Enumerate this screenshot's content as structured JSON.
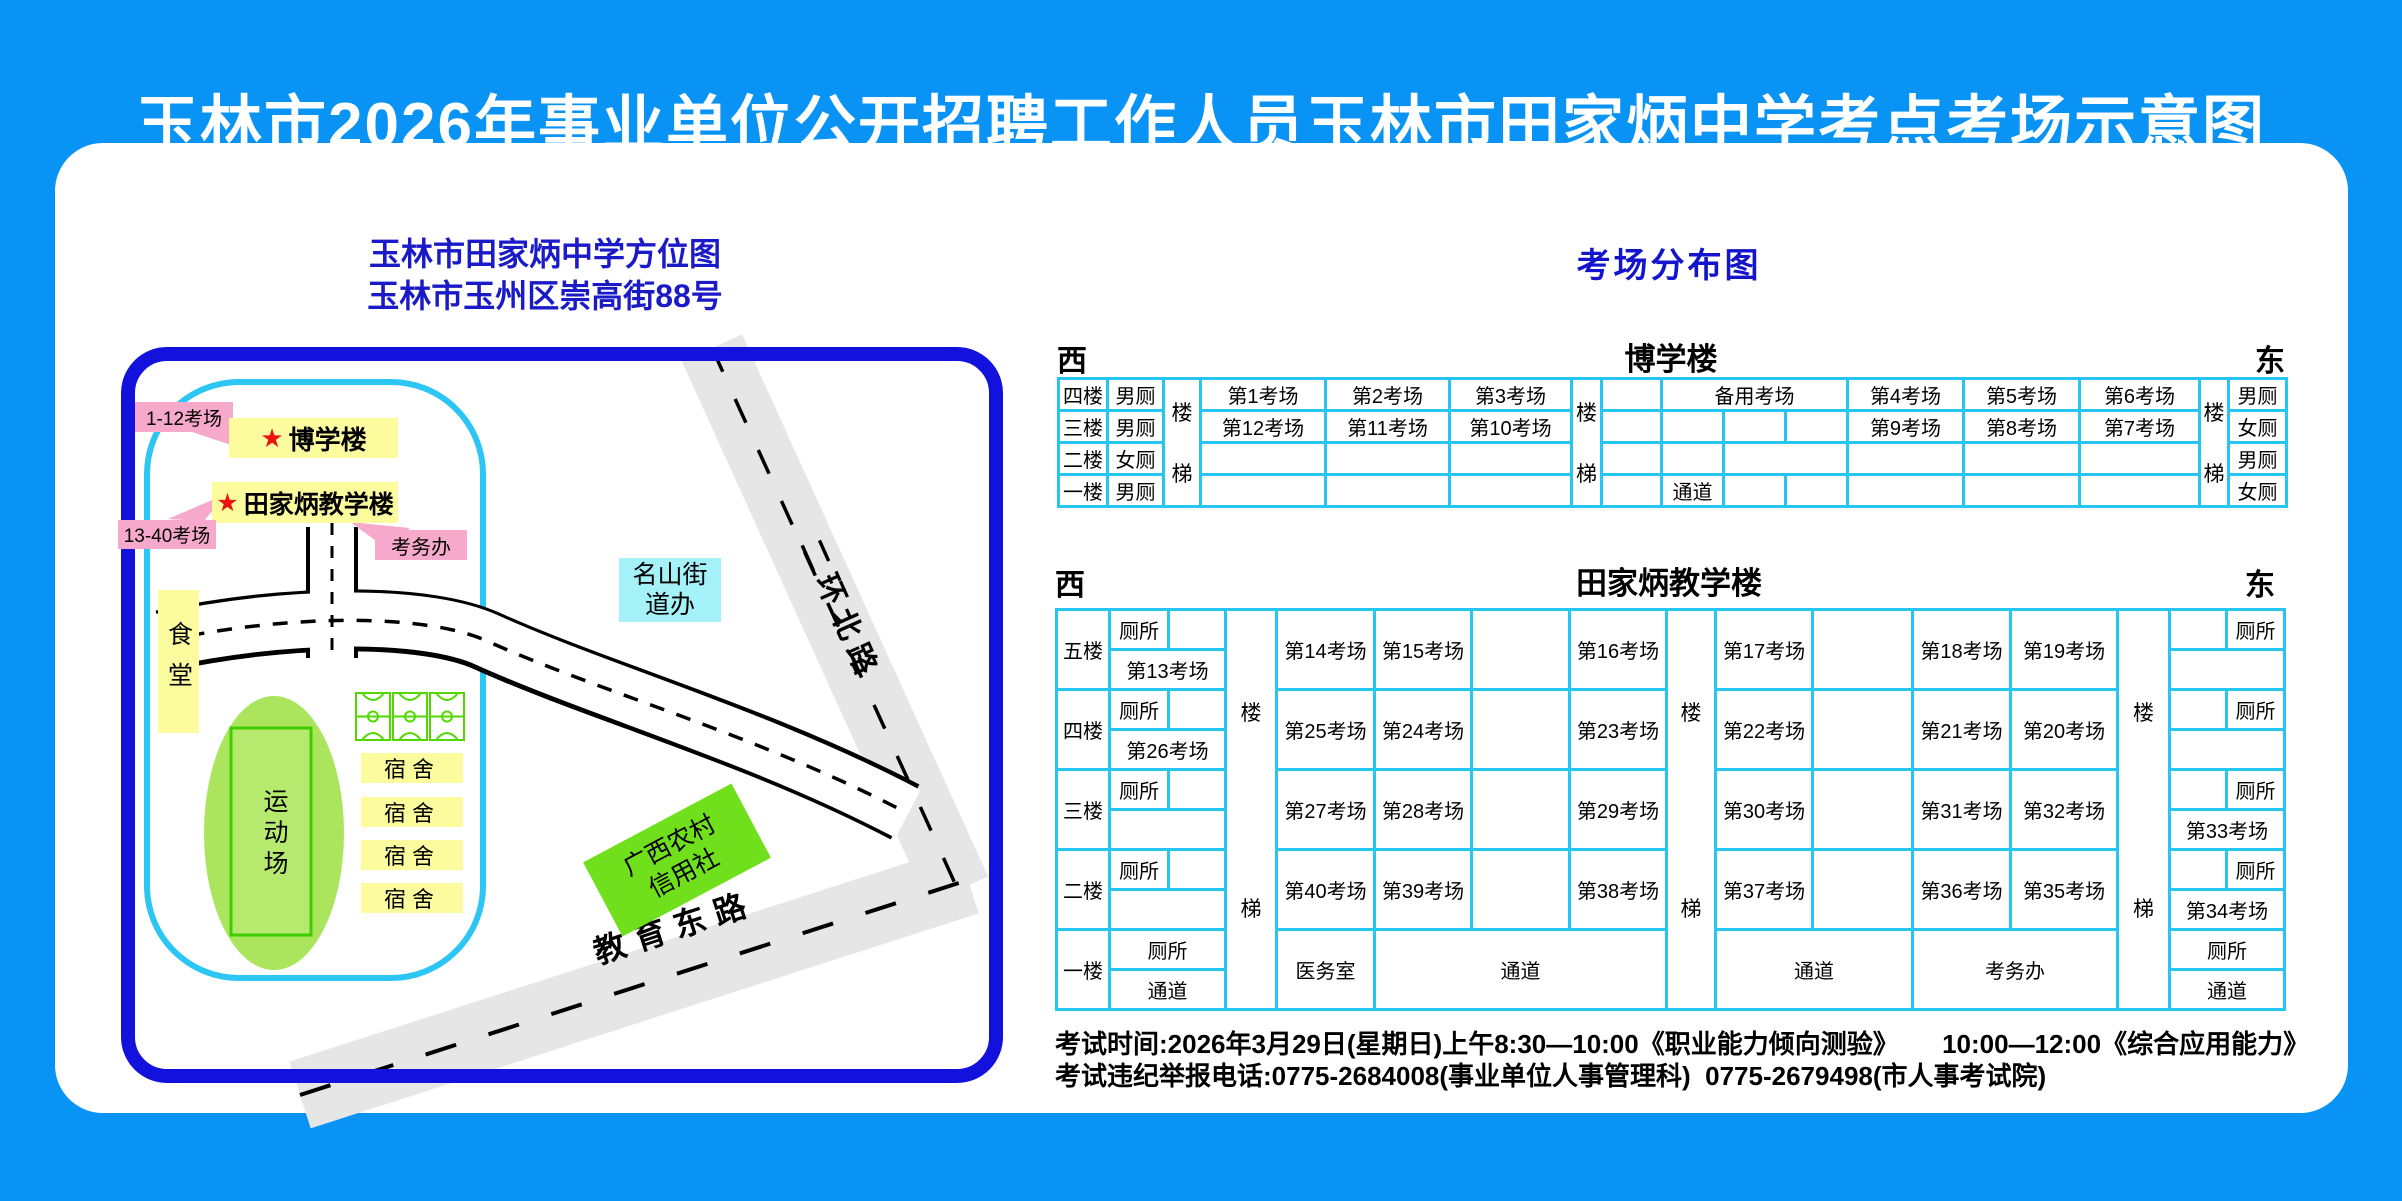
{
  "title": "玉林市2026年事业单位公开招聘工作人员玉林市田家炳中学考点考场示意图",
  "map": {
    "header_line1": "玉林市田家炳中学方位图",
    "header_line2": "玉林市玉州区崇高街88号",
    "star": "★",
    "tag_rooms_1_12": "1-12考场",
    "tag_rooms_13_40": "13-40考场",
    "building_boxue": "博学楼",
    "building_tianjiabing": "田家炳教学楼",
    "exam_office": "考务办",
    "canteen": "食堂",
    "sports_field": "运动场",
    "dorm": "宿舍",
    "street_office_line1": "名山街",
    "street_office_line2": "道办",
    "bank_line1": "广西农村",
    "bank_line2": "信用社",
    "roads": {
      "erhuanbeilu": "二环北路",
      "jiaoyudonglu": "教育东路"
    }
  },
  "distribution_title": "考场分布图",
  "table1": {
    "west": "西",
    "east": "东",
    "building": "博学楼",
    "stair_top": "楼",
    "stair_bottom": "梯",
    "floors": [
      "四楼",
      "三楼",
      "二楼",
      "一楼"
    ],
    "toilets_left": [
      "男厕",
      "男厕",
      "女厕",
      "男厕"
    ],
    "toilets_right": [
      "男厕",
      "女厕",
      "男厕",
      "女厕"
    ],
    "rooms_left_f4": [
      "第1考场",
      "第2考场",
      "第3考场"
    ],
    "rooms_left_f3": [
      "第12考场",
      "第11考场",
      "第10考场"
    ],
    "backup_room": "备用考场",
    "passage": "通道",
    "rooms_right_f4": [
      "第4考场",
      "第5考场",
      "第6考场"
    ],
    "rooms_right_f3": [
      "第9考场",
      "第8考场",
      "第7考场"
    ]
  },
  "table2": {
    "west": "西",
    "east": "东",
    "building": "田家炳教学楼",
    "stair_top": "楼",
    "stair_bottom": "梯",
    "floors": [
      "五楼",
      "四楼",
      "三楼",
      "二楼",
      "一楼"
    ],
    "toilet": "厕所",
    "passage": "通道",
    "room_13": "第13考场",
    "room_26": "第26考场",
    "room_33": "第33考场",
    "room_34": "第34考场",
    "medical_room": "医务室",
    "exam_office": "考务办",
    "rooms": {
      "f5": [
        "第14考场",
        "第15考场",
        "第16考场",
        "第17考场",
        "第18考场",
        "第19考场"
      ],
      "f4": [
        "第25考场",
        "第24考场",
        "第23考场",
        "第22考场",
        "第21考场",
        "第20考场"
      ],
      "f3": [
        "第27考场",
        "第28考场",
        "第29考场",
        "第30考场",
        "第31考场",
        "第32考场"
      ],
      "f2": [
        "第40考场",
        "第39考场",
        "第38考场",
        "第37考场",
        "第36考场",
        "第35考场"
      ]
    }
  },
  "footer": {
    "line1": "考试时间:2026年3月29日(星期日)上午8:30—10:00《职业能力倾向测验》      10:00—12:00《综合应用能力》",
    "line2": "考试违纪举报电话:0775-2684008(事业单位人事管理科)  0775-2679498(市人事考试院)"
  },
  "colors": {
    "background": "#0893F5",
    "panel": "#FFFFFF",
    "map_border": "#1212DC",
    "header_text": "#1A1AC8",
    "table_border": "#27C6F2",
    "label_yellow": "#FCFC9E",
    "label_pink": "#F7A9CC",
    "label_cyan": "#A4F2F8",
    "court_green": "#52D800",
    "field_green": "#ABE55E",
    "bank_green": "#70DF1C",
    "road_gray": "#E6E6E6",
    "star_red": "#EE1111",
    "campus_outline": "#2CC6F4"
  }
}
